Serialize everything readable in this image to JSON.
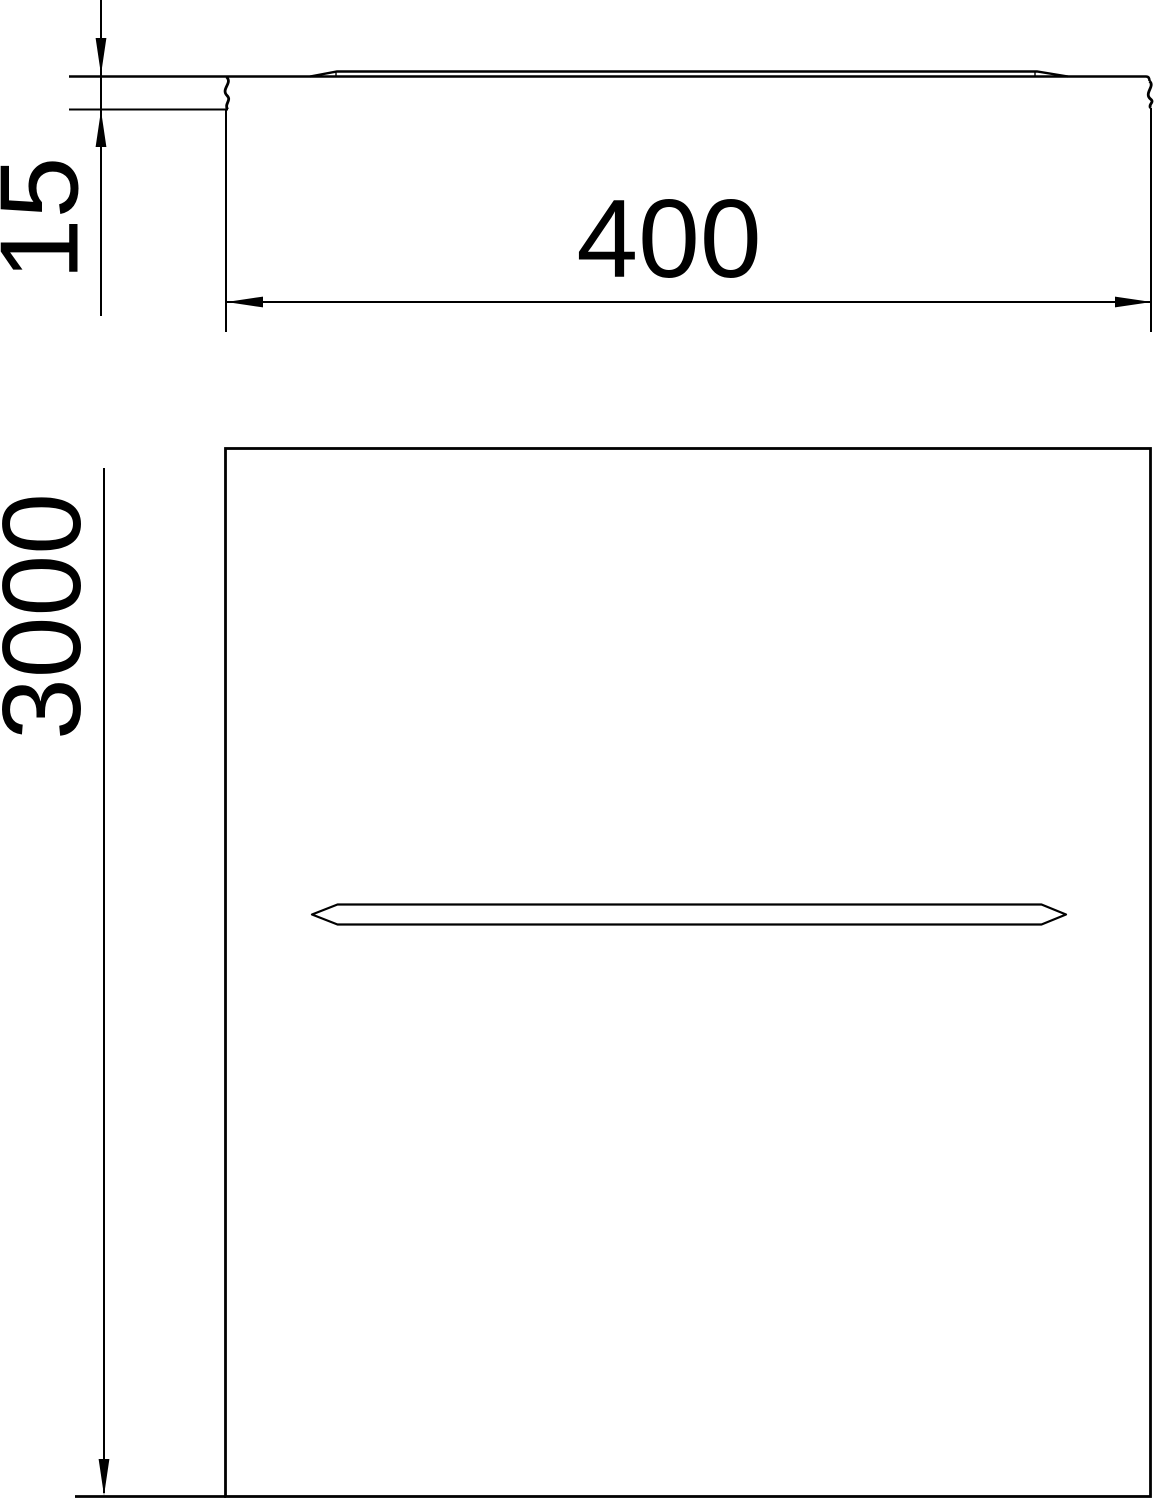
{
  "colors": {
    "line": "#000000",
    "text": "#000000",
    "background": "#ffffff"
  },
  "dimensions": {
    "profile_height": "15",
    "profile_width": "400",
    "plan_length": "3000"
  }
}
